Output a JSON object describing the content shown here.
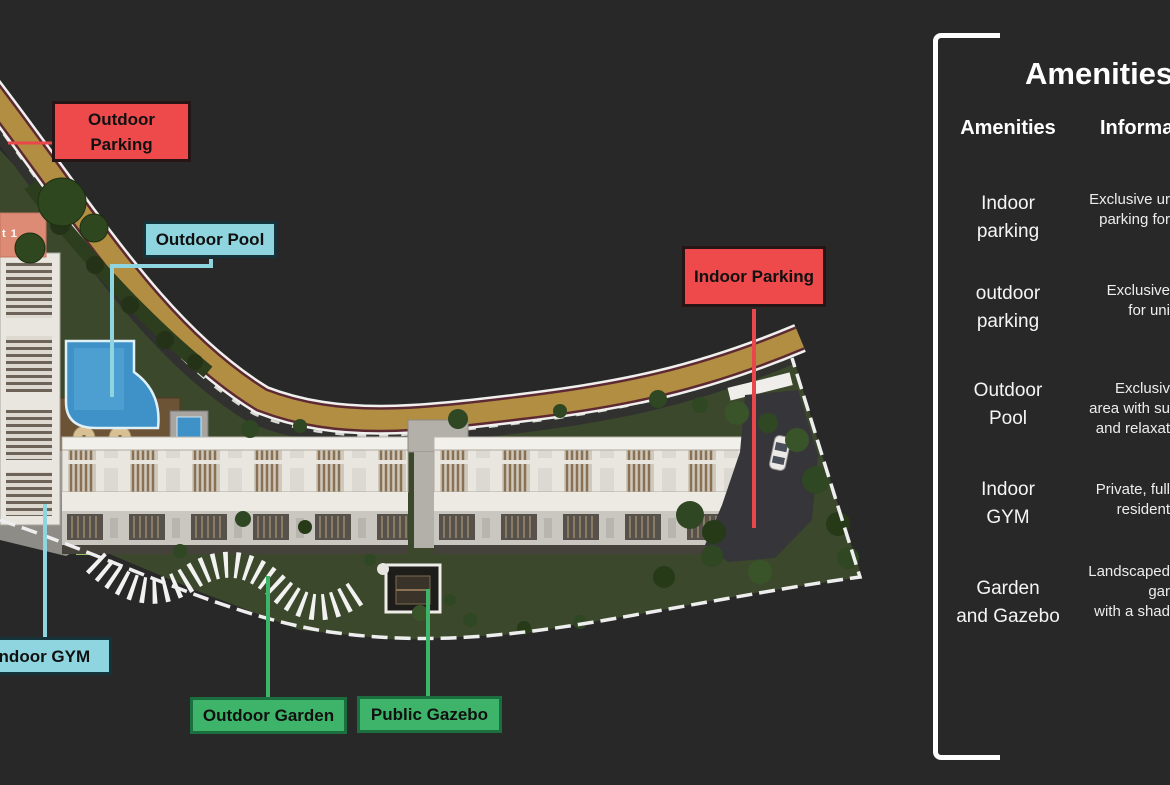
{
  "panel": {
    "title": "Amenities",
    "col_amenities": "Amenities",
    "col_information": "Information",
    "rows": [
      {
        "name1": "Indoor",
        "name2": "parking",
        "info": [
          "Exclusive ur",
          "parking for"
        ]
      },
      {
        "name1": "outdoor",
        "name2": "parking",
        "info": [
          "Exclusive",
          "for uni"
        ]
      },
      {
        "name1": "Outdoor",
        "name2": "Pool",
        "info": [
          "Exclusiv",
          "area with su",
          "and relaxat"
        ]
      },
      {
        "name1": "Indoor",
        "name2": "GYM",
        "info": [
          "Private, full",
          "resident"
        ]
      },
      {
        "name1": "Garden",
        "name2": "and Gazebo",
        "info": [
          "Landscaped",
          "gar",
          "with a shad"
        ]
      }
    ]
  },
  "labels": {
    "outdoor_parking_line1": "Outdoor",
    "outdoor_parking_line2": "Parking",
    "outdoor_pool": "Outdoor Pool",
    "indoor_parking": "Indoor Parking",
    "indoor_gym": "Indoor GYM",
    "outdoor_garden": "Outdoor Garden",
    "public_gazebo": "Public Gazebo"
  },
  "site": {
    "building_tag": "t 1"
  },
  "colors": {
    "label_red": "#ee4a4c",
    "label_cyan": "#8ed5df",
    "label_green": "#3eb46a",
    "road_gold": "#b28e42",
    "background": "#282828"
  }
}
